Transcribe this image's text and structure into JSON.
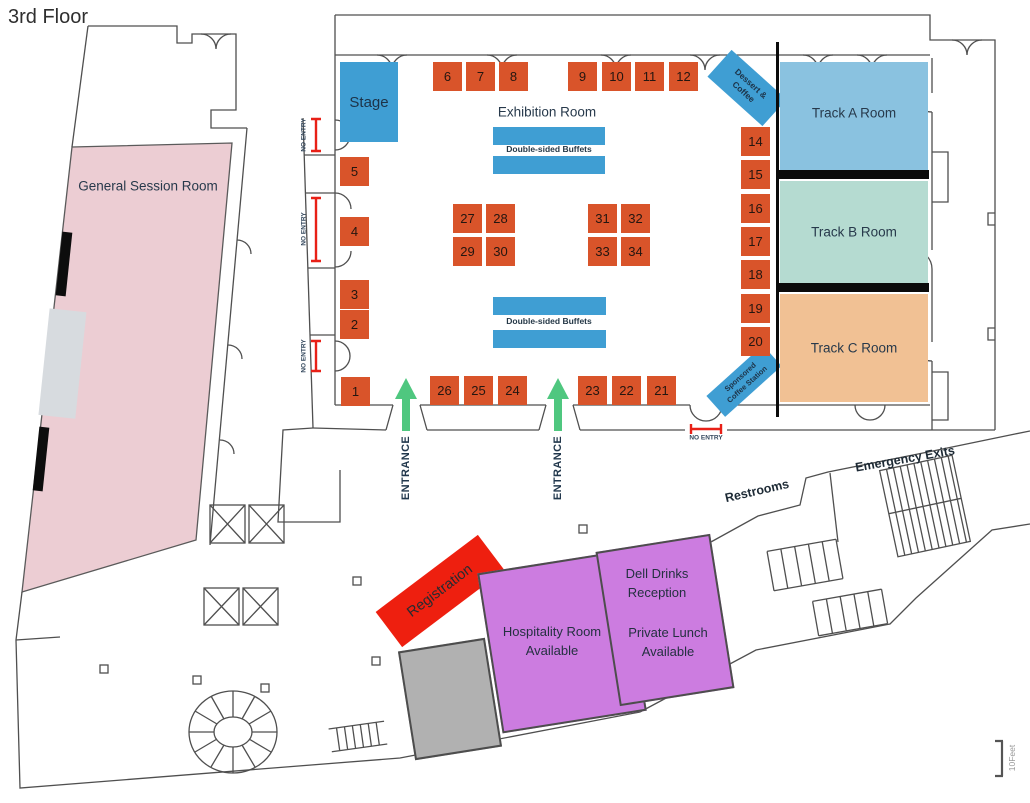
{
  "floor_label": "3rd Floor",
  "exhibition": {
    "title": "Exhibition Room",
    "stage": "Stage",
    "buffet_label_top": "Double-sided Buffets",
    "buffet_label_bottom": "Double-sided Buffets",
    "dessert_station": {
      "line1": "Dessert &",
      "line2": "Coffee"
    },
    "sponsored_station": {
      "line1": "Sponsored",
      "line2": "Coffee Station"
    },
    "booths": {
      "top_left": [
        "6",
        "7",
        "8"
      ],
      "top_right": [
        "9",
        "10",
        "11",
        "12"
      ],
      "left_column": [
        "5",
        "4",
        "3",
        "2"
      ],
      "bottom_left": [
        "1",
        "26",
        "25",
        "24"
      ],
      "bottom_right": [
        "23",
        "22",
        "21"
      ],
      "center_left": [
        "27",
        "28",
        "29",
        "30"
      ],
      "center_right": [
        "31",
        "32",
        "33",
        "34"
      ],
      "right_column": [
        "14",
        "15",
        "16",
        "17",
        "18",
        "19",
        "20"
      ]
    },
    "entrance_left": "ENTRANCE",
    "entrance_right": "ENTRANCE",
    "no_entry_bottom": "NO ENTRY",
    "no_entry_left": [
      "NO ENTRY",
      "NO ENTRY",
      "NO ENTRY"
    ]
  },
  "rooms": {
    "general_session": "General Session Room",
    "track_a": "Track A Room",
    "track_b": "Track B Room",
    "track_c": "Track C Room",
    "registration": "Registration",
    "hospitality": {
      "line1": "Hospitality Room",
      "line2": "Available"
    },
    "dell_reception": {
      "line1": "Dell Drinks",
      "line2": "Reception"
    },
    "private_lunch": {
      "line1": "Private Lunch",
      "line2": "Available"
    }
  },
  "annotations": {
    "restrooms": "Restrooms",
    "emergency_exits": "Emergency Exits",
    "scale": "10Feet"
  },
  "colors": {
    "booth_orange": "#d9542a",
    "stage_blue": "#3f9ed3",
    "track_a_blue": "#8ac2e0",
    "track_b_teal": "#b5dbd1",
    "track_c_tan": "#f1c194",
    "session_pink": "#eccdd3",
    "purple": "#cc7ce0",
    "registration_red": "#ee1f0f",
    "gray_room": "#b1b1b1",
    "entrance_green": "#4fc77f",
    "no_entry_red": "#e82017"
  }
}
